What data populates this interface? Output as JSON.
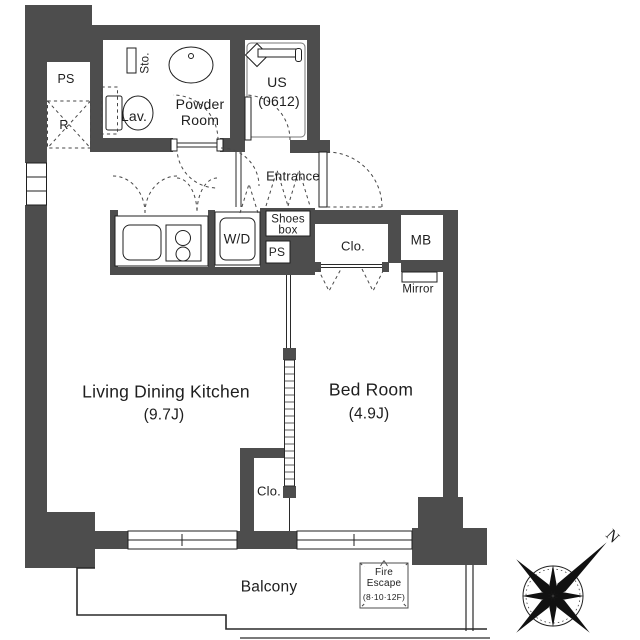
{
  "floor_plan": {
    "rooms": {
      "powder_room": {
        "line1": "Powder",
        "line2": "Room"
      },
      "unit_shower": {
        "line1": "US",
        "line2": "(0612)"
      },
      "entrance": "Entrance",
      "living_dining_kitchen": {
        "line1": "Living Dining Kitchen",
        "line2": "(9.7J)"
      },
      "bed_room": {
        "line1": "Bed Room",
        "line2": "(4.9J)"
      },
      "balcony": "Balcony"
    },
    "fixtures": {
      "pipe_space_top": "PS",
      "refrigerator_space": "R",
      "storage": "Sto.",
      "lavatory": "Lav.",
      "shoes_box": {
        "line1": "Shoes",
        "line2": "box"
      },
      "washer_dryer": "W/D",
      "pipe_space_hall": "PS",
      "closet_upper": "Clo.",
      "meter_box": "MB",
      "mirror": "Mirror",
      "closet_lower": "Clo."
    },
    "annotations": {
      "fire_escape": {
        "line1": "Fire",
        "line2": "Escape",
        "line3": "(8·10·12F)"
      },
      "compass_north": "N"
    },
    "colors": {
      "wall": "#4d4d4d",
      "line": "#1f1f1f",
      "text": "#1e1e1e",
      "background": "#ffffff"
    }
  }
}
